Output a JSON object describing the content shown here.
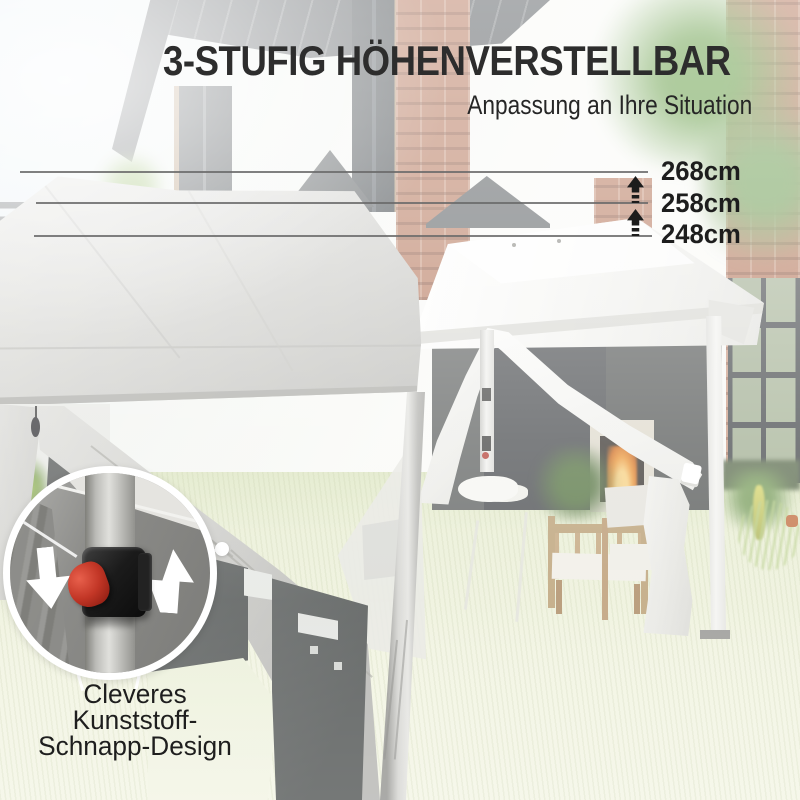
{
  "header": {
    "title": "3-STUFIG HÖHENVERSTELLBAR",
    "subtitle": "Anpassung an Ihre Situation"
  },
  "measurements": {
    "unit": "cm",
    "lines": [
      {
        "label": "268cm"
      },
      {
        "label": "258cm"
      },
      {
        "label": "248cm"
      }
    ],
    "arrow_icon": "up-arrow-striped"
  },
  "inset": {
    "caption_lines": [
      "Cleveres",
      "Kunststoff-",
      "Schnapp-Design"
    ],
    "icons": [
      "down-arrow",
      "up-arrow"
    ],
    "mechanism": "red-snap-lever"
  },
  "colors": {
    "text_dark": "#2d2d2d",
    "accent_red": "#c0392b",
    "line_gray": "#6a6a6a",
    "grass": "#eef2dc",
    "canopy_white": "#f4f4f1",
    "canopy_gray": "#d4d4d0"
  }
}
